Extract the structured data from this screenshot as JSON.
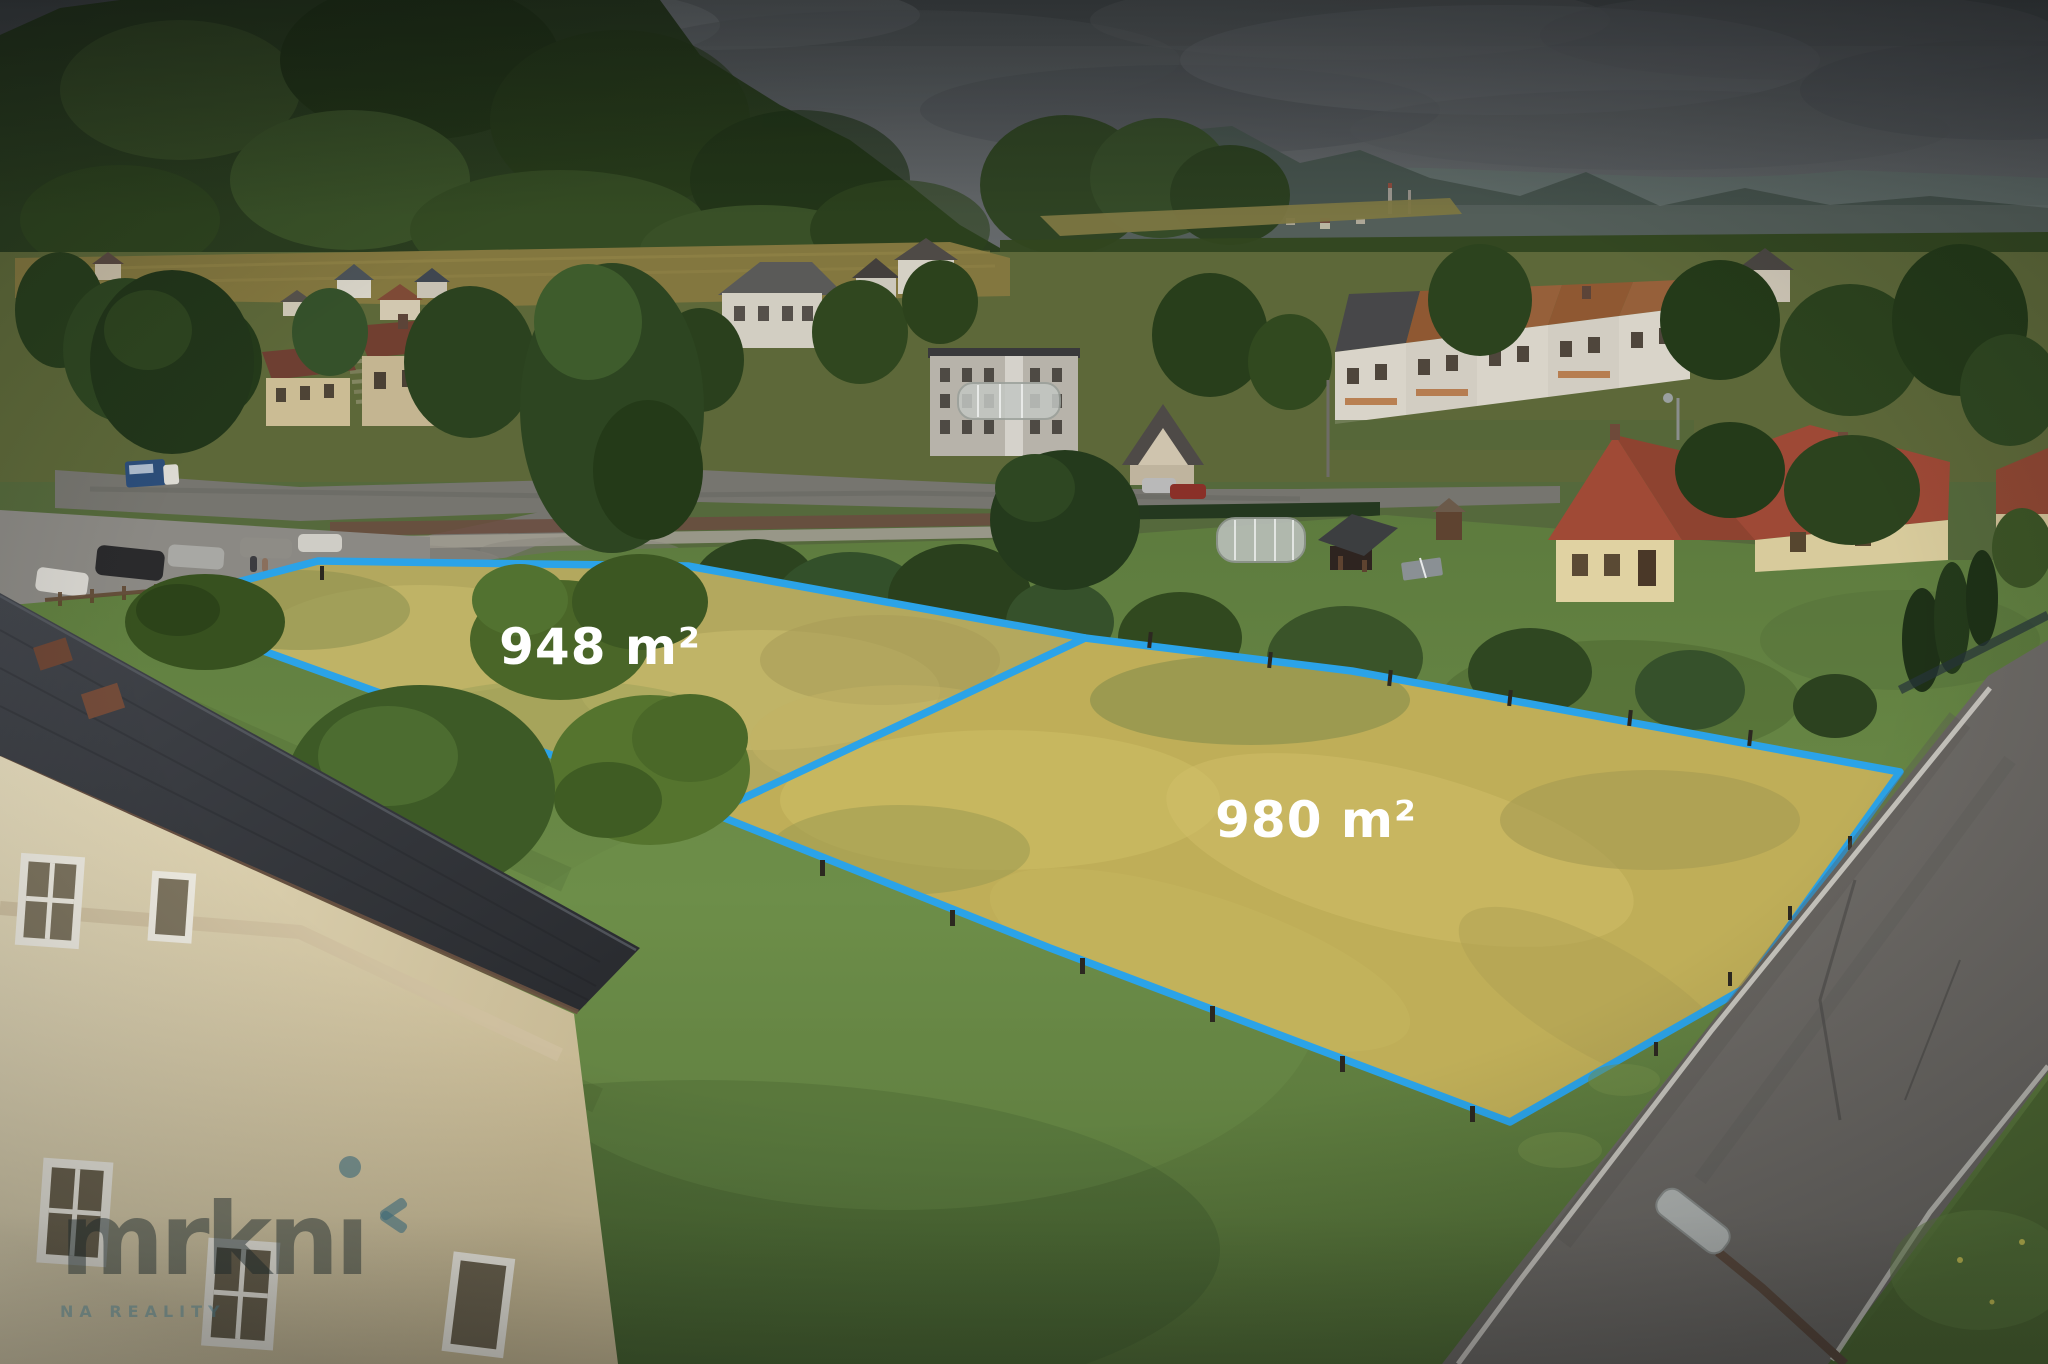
{
  "photo": {
    "kind": "aerial-drone-photo-of-building-plots",
    "parcels": [
      {
        "name": "parcel-left",
        "area_label": "948 m²",
        "outline_points": "142,607 318,561 688,566 1085,638 712,813"
      },
      {
        "name": "parcel-right",
        "area_label": "980 m²",
        "outline_points": "1085,638 1352,671 1900,772 1745,988 1510,1122 1050,948 712,813"
      }
    ],
    "watermark": {
      "brand": "mrkni",
      "brand_stem": "mrkn",
      "brand_tail_dotless_i": "ı",
      "tagline": "NA REALITY"
    },
    "colors": {
      "parcel_outline": "#2BA3E8",
      "area_label_text": "#FFFFFF",
      "watermark_ink": "rgba(25,38,40,0.48)",
      "watermark_accent": "rgba(62,105,120,0.62)"
    }
  }
}
